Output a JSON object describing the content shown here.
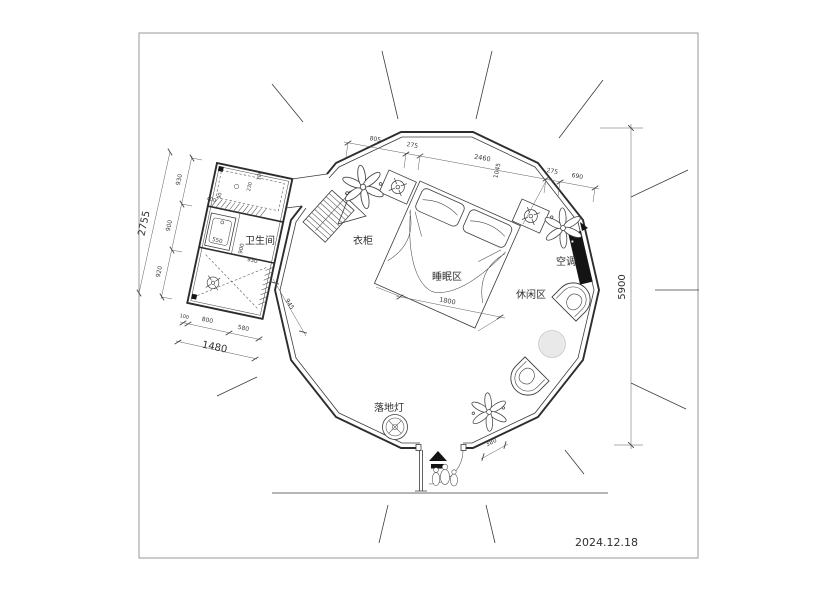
{
  "titleblock": {
    "date": "2024.12.18"
  },
  "labels": {
    "bathroom": "卫生间",
    "wardrobe": "衣柜",
    "sleeping_area": "睡眠区",
    "leisure_area": "休闲区",
    "air_conditioner": "空调",
    "floor_lamp": "落地灯"
  },
  "dims": {
    "top": [
      "805",
      "275",
      "2460",
      "275",
      "690"
    ],
    "top_v": "1045",
    "height": "5900",
    "bed": "1800",
    "entry": "380",
    "bath_left": [
      "930",
      "900",
      "920"
    ],
    "bath_left_total": "2755",
    "bath_bottom": [
      "100",
      "800",
      "580"
    ],
    "bath_bottom_total": "1480",
    "bath_step": "945",
    "bath_sink": "550",
    "bath_in_depth": "900",
    "bath_in_width": "930",
    "shower": [
      "400",
      "90",
      "230",
      "100"
    ]
  },
  "colors": {
    "line": "#3c3c3c",
    "dim_line": "#5c5c5c",
    "text": "#2f2f2f",
    "solid": "#141414",
    "table_fill": "#e9e9e9",
    "frame": "#9a9a9a"
  }
}
